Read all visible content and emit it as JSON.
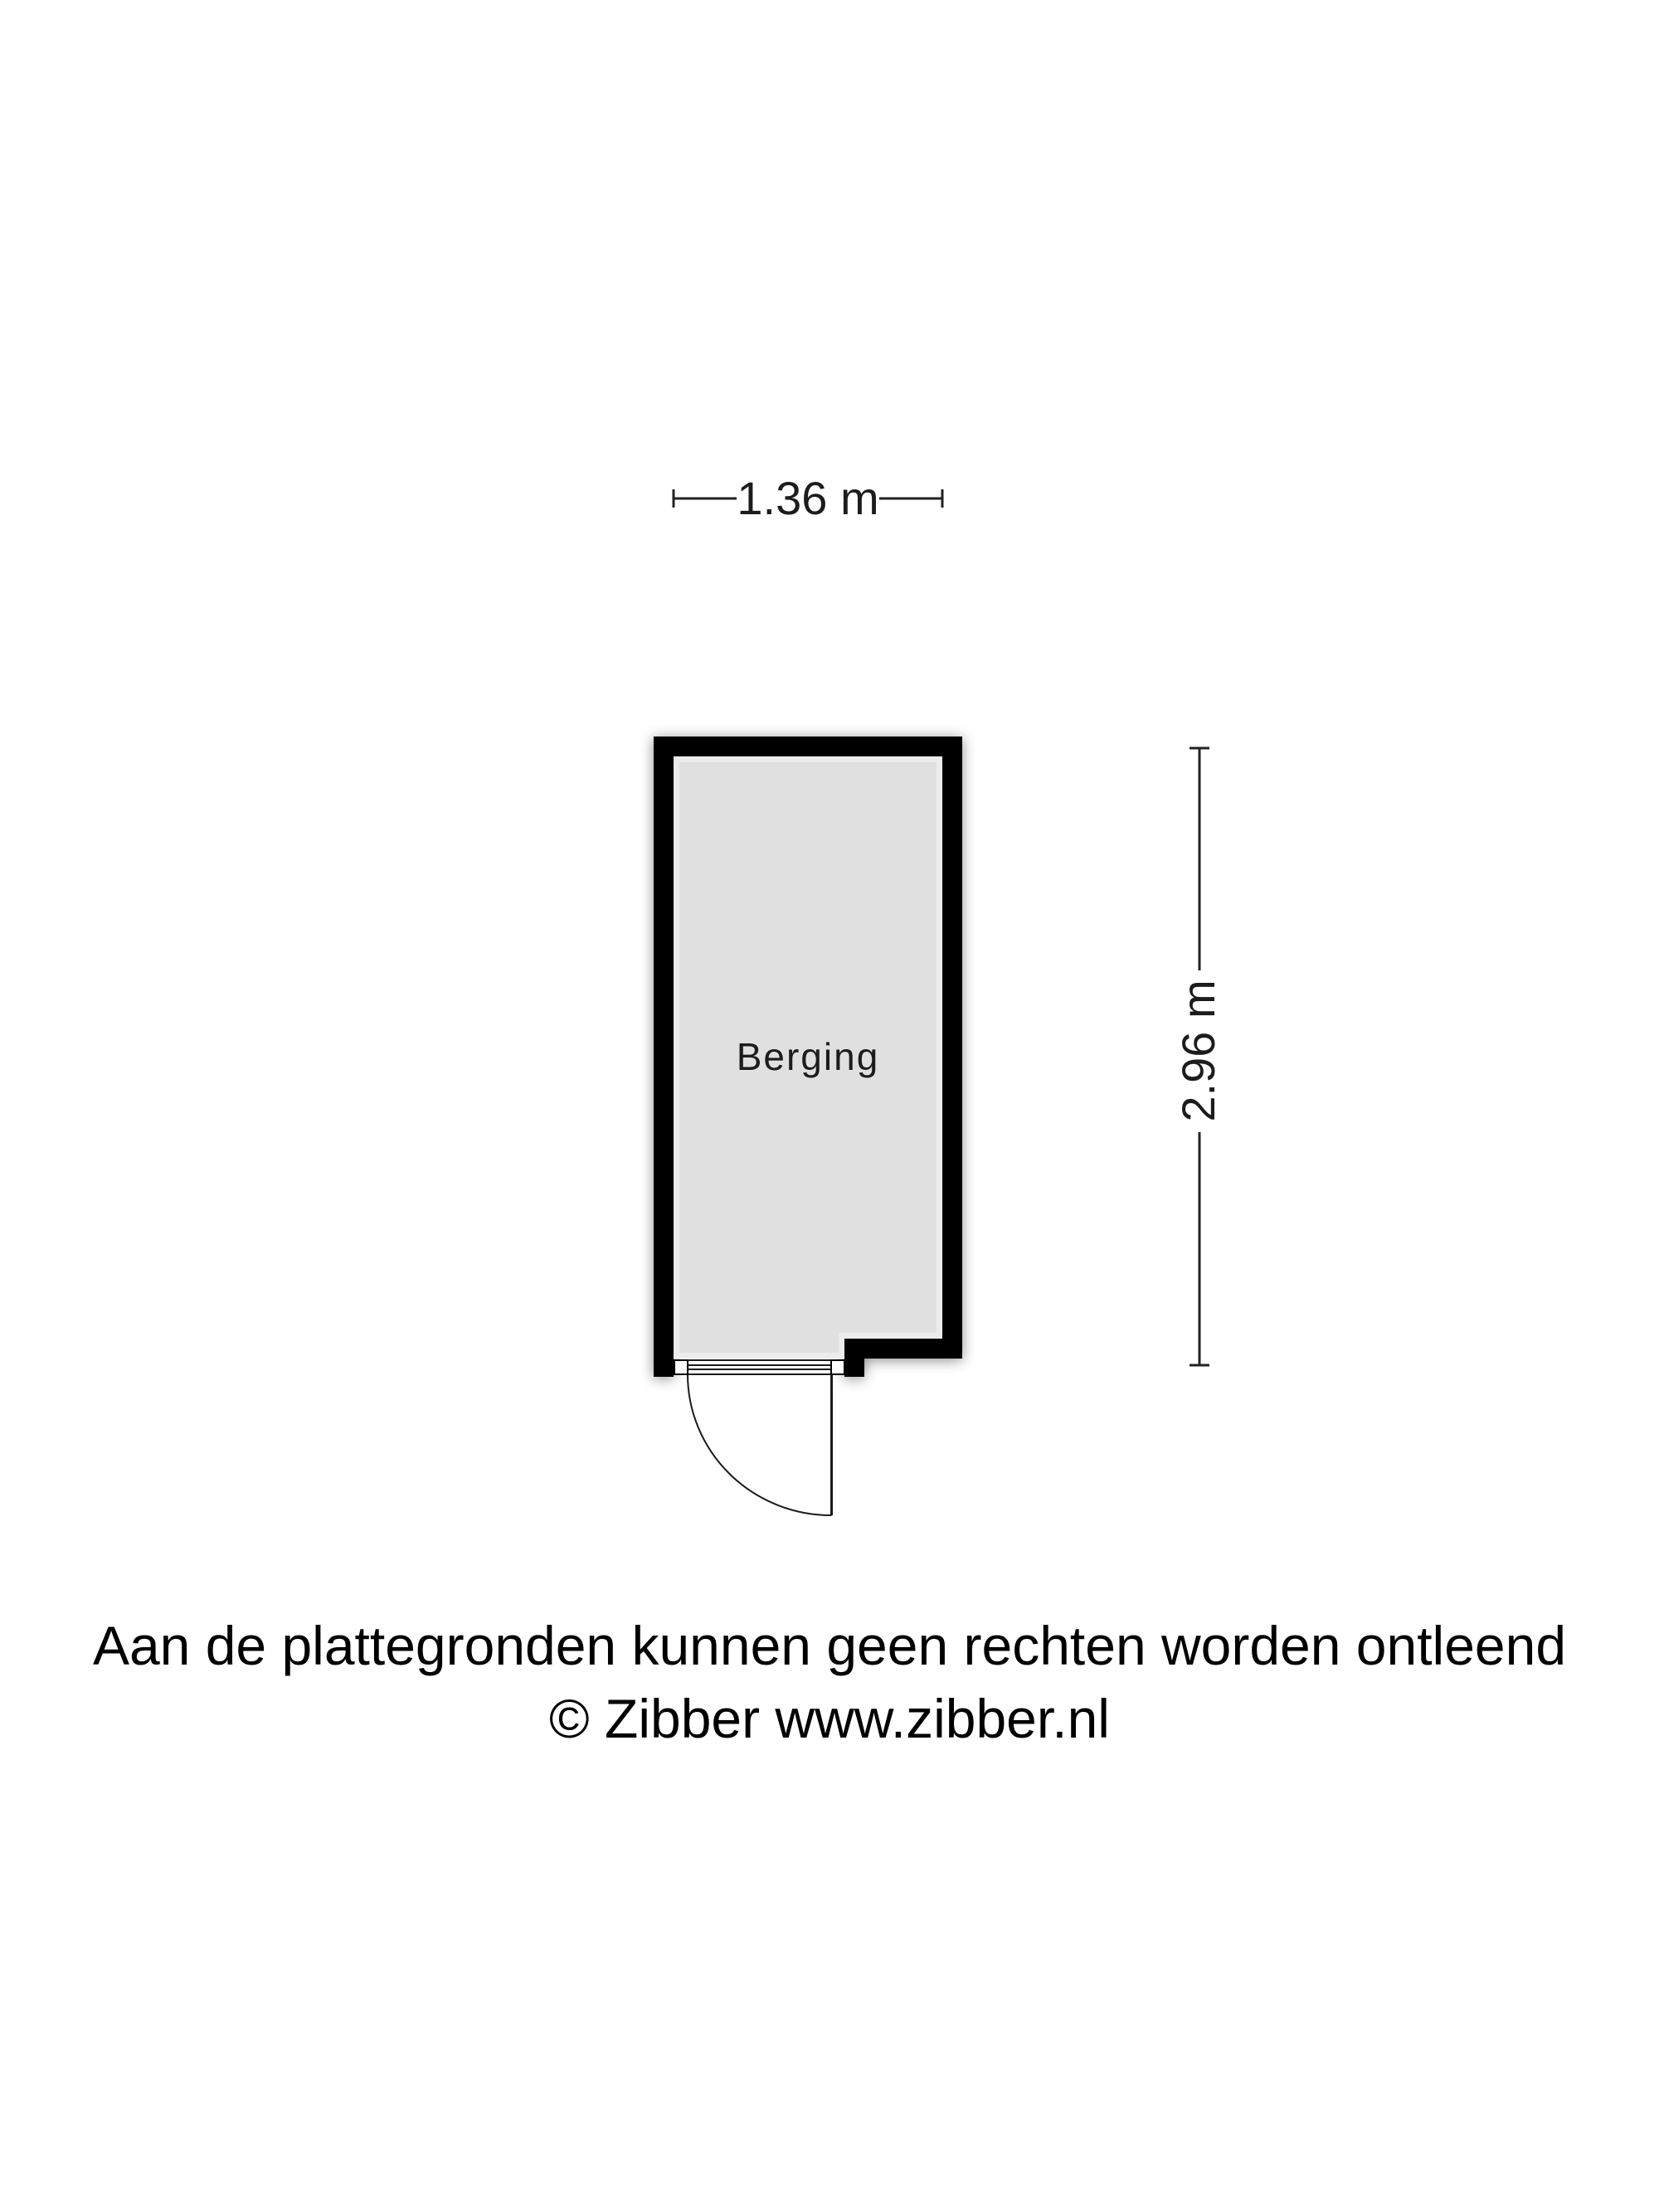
{
  "floorplan": {
    "room_label": "Berging",
    "dimension_width": "1.36 m",
    "dimension_height": "2.96 m"
  },
  "footer": {
    "disclaimer": "Aan de plattegronden kunnen geen rechten worden ontleend",
    "copyright": "© Zibber www.zibber.nl"
  },
  "colors": {
    "wall": "#000000",
    "floor_fill": "#e0e0e0",
    "floor_rim": "#ececec",
    "line": "#1c1c1c",
    "background": "#ffffff"
  }
}
